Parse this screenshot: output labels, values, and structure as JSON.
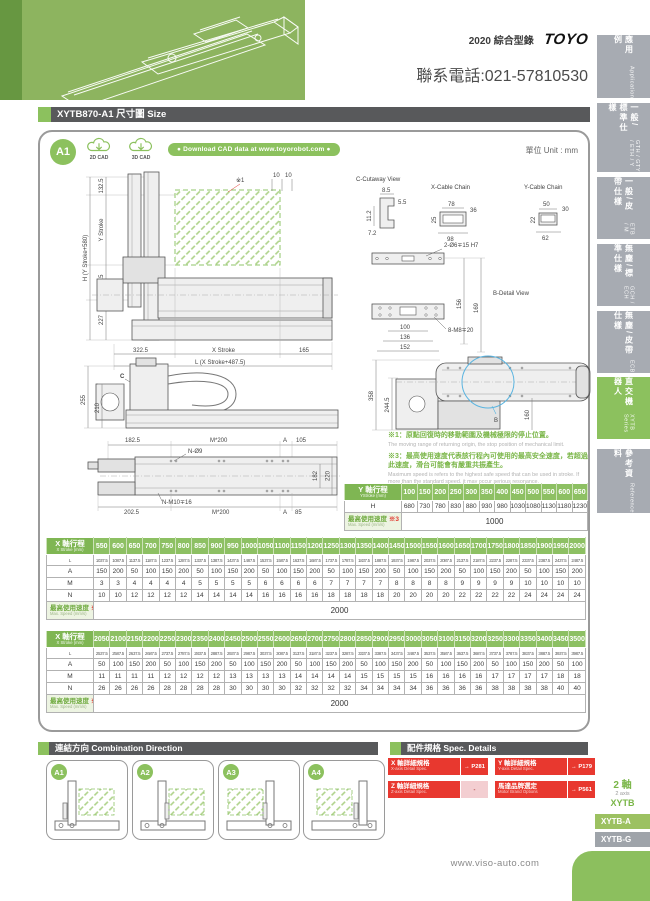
{
  "page": {
    "catalog": "2020 綜合型錄",
    "brand": "TOYO",
    "phone": "聯系電話:021-57810530",
    "unit": "單位 Unit : mm",
    "website": "www.viso-auto.com"
  },
  "title_bar": {
    "title": "XYTB870-A1 尺寸圖 Size"
  },
  "cad": {
    "badge": "A1",
    "cad_2d": "2D CAD",
    "cad_3d": "3D CAD",
    "pill": "● Download CAD data at www.toyorobot.com ●"
  },
  "sidebar": {
    "tabs": [
      {
        "zh": "應用例",
        "en": "Application"
      },
      {
        "zh": "一般/標準仕樣",
        "en": "GTH / GTY / ETH / Y"
      },
      {
        "zh": "一般/皮帶仕樣",
        "en": "ETB / M"
      },
      {
        "zh": "無塵/標準仕樣",
        "en": "GCH / ECH"
      },
      {
        "zh": "無塵/皮帶仕樣",
        "en": "ECB"
      },
      {
        "zh": "直交機器人",
        "en": "XYTB Series"
      },
      {
        "zh": "參考資料",
        "en": "Reference"
      }
    ],
    "series_axis_zh": "2 軸",
    "series_axis_en": "2 axis",
    "series_family": "XYTB",
    "model_a": "XYTB-A",
    "model_g": "XYTB-G"
  },
  "views": {
    "front": {
      "ref1": "※1",
      "d132": "132.5",
      "dys": "Y Stroke",
      "dh": "H (Y Stroke+580)",
      "d220": "220.5",
      "d227": "227",
      "d322": "322.5",
      "dxs": "X Stroke",
      "d165": "165",
      "dl": "L (X Stroke+487.5)",
      "d10a": "10",
      "d10b": "10"
    },
    "cutaway": {
      "title": "C-Cutaway View",
      "d85": "8.5",
      "d55": "5.5",
      "d112": "11.2",
      "d72": "7.2"
    },
    "xchain": {
      "title": "X-Cable Chain",
      "d78": "78",
      "d36": "36",
      "d25": "25",
      "d98": "98"
    },
    "ychain": {
      "title": "Y-Cable Chain",
      "d50": "50",
      "d30": "30",
      "d22": "22",
      "d62": "62"
    },
    "bdetail": {
      "title": "B-Detail View",
      "hole": "2-Ø6∓15 H7",
      "d156": "156",
      "d169": "169",
      "d100": "100",
      "d136": "136",
      "d152": "152",
      "screw": "8-M8∓20",
      "marker": "B"
    },
    "side": {
      "marker": "C",
      "d255": "255",
      "d210": "210"
    },
    "top": {
      "d358": "358",
      "d2445": "244.5",
      "d160": "160"
    },
    "plan": {
      "d1825": "182.5",
      "m200a": "M*200",
      "aa": "A",
      "d105": "105",
      "no9": "N-Ø9",
      "d182": "182",
      "d220": "220",
      "d2025": "202.5",
      "nm10": "N-M10∓16",
      "m200b": "M*200",
      "ab": "A",
      "d85": "85"
    }
  },
  "notes": {
    "n1_zh": "※1：原點回復時的移動範圍及機械極限的停止位置。",
    "n1_en": "The moving range of returning origin, the stop position of mechanical limit.",
    "n3_zh": "※3：最高使用速度代表該行程內可使用的最高安全速度，若超過此速度，滑台可能會有嚴重共振產生。",
    "n3_en": "Maximum speed is refers to the highest safe speed that can be used in stroke. If more than the standard speed, it may occur serious resonance."
  },
  "y_table": {
    "label_zh": "Y 軸行程",
    "label_en": "YStroke (mm)",
    "strokes": [
      "100",
      "150",
      "200",
      "250",
      "300",
      "350",
      "400",
      "450",
      "500",
      "550",
      "600",
      "650"
    ],
    "rows": [
      {
        "label": "H",
        "values": [
          "680",
          "730",
          "780",
          "830",
          "880",
          "930",
          "980",
          "1030",
          "1080",
          "1130",
          "1180",
          "1230"
        ]
      }
    ],
    "speed_zh": "最高使用速度",
    "speed_note": "※3",
    "speed_en": "Max. Speed (mm/s)",
    "speed_value": "1000"
  },
  "x_table_1": {
    "label_zh": "X 軸行程",
    "label_en": "X Stroke (mm)",
    "strokes": [
      "550",
      "600",
      "650",
      "700",
      "750",
      "800",
      "850",
      "900",
      "950",
      "1000",
      "1050",
      "1100",
      "1150",
      "1200",
      "1250",
      "1300",
      "1350",
      "1400",
      "1450",
      "1500",
      "1550",
      "1600",
      "1650",
      "1700",
      "1750",
      "1800",
      "1850",
      "1900",
      "1950",
      "2000"
    ],
    "rows": [
      {
        "label": "L",
        "values": [
          "1037.5",
          "1087.5",
          "1137.5",
          "1187.5",
          "1237.5",
          "1287.5",
          "1337.5",
          "1387.5",
          "1437.5",
          "1487.5",
          "1537.5",
          "1587.5",
          "1637.5",
          "1687.5",
          "1737.5",
          "1787.5",
          "1837.5",
          "1887.5",
          "1937.5",
          "1987.5",
          "2037.5",
          "2087.5",
          "2137.5",
          "2187.5",
          "2237.5",
          "2287.5",
          "2337.5",
          "2387.5",
          "2437.5",
          "2487.5"
        ]
      },
      {
        "label": "A",
        "values": [
          "150",
          "200",
          "50",
          "100",
          "150",
          "200",
          "50",
          "100",
          "150",
          "200",
          "50",
          "100",
          "150",
          "200",
          "50",
          "100",
          "150",
          "200",
          "50",
          "100",
          "150",
          "200",
          "50",
          "100",
          "150",
          "200",
          "50",
          "100",
          "150",
          "200"
        ]
      },
      {
        "label": "M",
        "values": [
          "3",
          "3",
          "4",
          "4",
          "4",
          "4",
          "5",
          "5",
          "5",
          "5",
          "6",
          "6",
          "6",
          "6",
          "7",
          "7",
          "7",
          "7",
          "8",
          "8",
          "8",
          "8",
          "9",
          "9",
          "9",
          "9",
          "10",
          "10",
          "10",
          "10"
        ]
      },
      {
        "label": "N",
        "values": [
          "10",
          "10",
          "12",
          "12",
          "12",
          "12",
          "14",
          "14",
          "14",
          "14",
          "16",
          "16",
          "16",
          "16",
          "18",
          "18",
          "18",
          "18",
          "20",
          "20",
          "20",
          "20",
          "22",
          "22",
          "22",
          "22",
          "24",
          "24",
          "24",
          "24"
        ]
      }
    ],
    "speed_zh": "最高使用速度",
    "speed_note": "※3",
    "speed_en": "Max. Speed (mm/s)",
    "speed_value": "2000"
  },
  "x_table_2": {
    "label_zh": "X 軸行程",
    "label_en": "X Stroke (mm)",
    "strokes": [
      "2050",
      "2100",
      "2150",
      "2200",
      "2250",
      "2300",
      "2350",
      "2400",
      "2450",
      "2500",
      "2550",
      "2600",
      "2650",
      "2700",
      "2750",
      "2800",
      "2850",
      "2900",
      "2950",
      "3000",
      "3050",
      "3100",
      "3150",
      "3200",
      "3250",
      "3300",
      "3350",
      "3400",
      "3450",
      "3500"
    ],
    "rows": [
      {
        "label": "L",
        "values": [
          "2537.5",
          "2587.5",
          "2637.5",
          "2687.5",
          "2737.5",
          "2787.5",
          "2837.5",
          "2887.5",
          "2937.5",
          "2987.5",
          "3037.5",
          "3087.5",
          "3137.5",
          "3187.5",
          "3237.5",
          "3287.5",
          "3337.5",
          "3387.5",
          "3437.5",
          "3487.5",
          "3537.5",
          "3587.5",
          "3637.5",
          "3687.5",
          "3737.5",
          "3787.5",
          "3837.5",
          "3887.5",
          "3937.5",
          "3987.5"
        ]
      },
      {
        "label": "A",
        "values": [
          "50",
          "100",
          "150",
          "200",
          "50",
          "100",
          "150",
          "200",
          "50",
          "100",
          "150",
          "200",
          "50",
          "100",
          "150",
          "200",
          "50",
          "100",
          "150",
          "200",
          "50",
          "100",
          "150",
          "200",
          "50",
          "100",
          "150",
          "200",
          "50",
          "100"
        ]
      },
      {
        "label": "M",
        "values": [
          "11",
          "11",
          "11",
          "11",
          "12",
          "12",
          "12",
          "12",
          "13",
          "13",
          "13",
          "13",
          "14",
          "14",
          "14",
          "14",
          "15",
          "15",
          "15",
          "15",
          "16",
          "16",
          "16",
          "16",
          "17",
          "17",
          "17",
          "17",
          "18",
          "18"
        ]
      },
      {
        "label": "N",
        "values": [
          "26",
          "26",
          "26",
          "26",
          "28",
          "28",
          "28",
          "28",
          "30",
          "30",
          "30",
          "30",
          "32",
          "32",
          "32",
          "32",
          "34",
          "34",
          "34",
          "34",
          "36",
          "36",
          "36",
          "36",
          "38",
          "38",
          "38",
          "38",
          "40",
          "40"
        ]
      }
    ],
    "speed_zh": "最高使用速度",
    "speed_note": "※3",
    "speed_en": "Max. Speed (mm/s)",
    "speed_value": "2000"
  },
  "combination": {
    "header_zh": "連結方向",
    "header_en": "Combination Direction",
    "cards": [
      "A1",
      "A2",
      "A3",
      "A4"
    ]
  },
  "spec": {
    "header_zh": "配件規格",
    "header_en": "Spec. Details",
    "items": [
      {
        "zh": "X 軸詳細規格",
        "en": "X-axis Detail Spec.",
        "page": "→ P281"
      },
      {
        "zh": "Y 軸詳細規格",
        "en": "Y-axis Detail Spec.",
        "page": "→ P179"
      },
      {
        "zh": "Z 軸詳細規格",
        "en": "Z-axis Detail Spec.",
        "page": "-"
      },
      {
        "zh": "馬達品牌選定",
        "en": "Motor Brand Options",
        "page": "→ P561"
      }
    ]
  }
}
